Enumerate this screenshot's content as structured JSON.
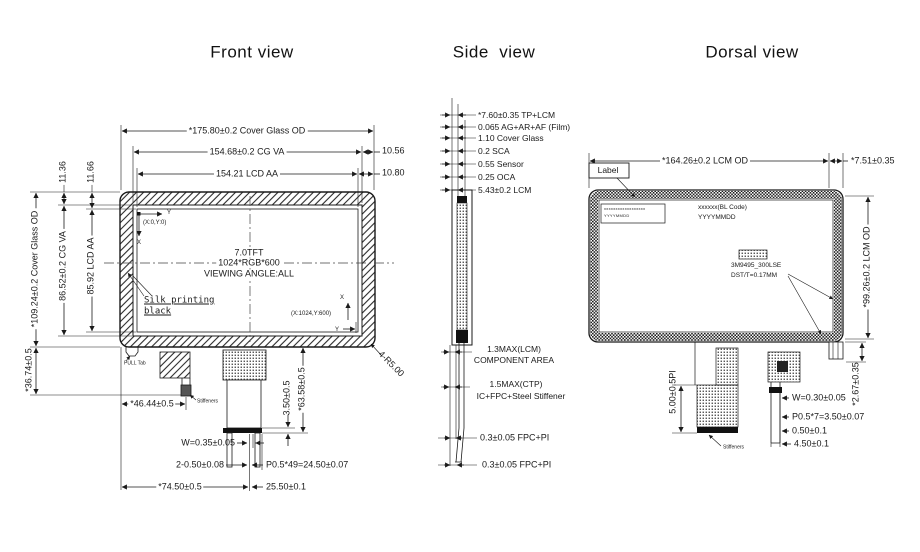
{
  "colors": {
    "ink": "#1a1a1a",
    "paper": "#ffffff"
  },
  "front": {
    "title": "Front view",
    "dims": {
      "width_od": "*175.80±0.2 Cover Glass OD",
      "width_va": "154.68±0.2 CG VA",
      "width_aa": "154.21 LCD AA",
      "right_margin_va": "10.56",
      "right_margin_aa": "10.80",
      "height_od": "*109.24±0.2 Cover Glass OD",
      "height_va": "86.52±0.2 CG VA",
      "height_aa": "85.92 LCD AA",
      "top_margin_va": "11.36",
      "top_margin_aa": "11.66",
      "tail_length": "*36.74±0.5",
      "stiffener_offset": "*46.44±0.5",
      "contact_width": "W=0.35±0.05",
      "hole_dia": "2-0.50±0.08",
      "fpc_offset": "*74.50±0.5",
      "pin_pitch": "P0.5*49=24.50±0.07",
      "connector_width": "25.50±0.1",
      "contact_depth": "3.50±0.5",
      "fpc_length": "*63.58±0.5",
      "corner_radius": "4-R5.00"
    },
    "screen": {
      "line1": "7.0TFT",
      "line2": "1024*RGB*600",
      "line3": "VIEWING ANGLE:ALL",
      "origin": "(X:0,Y:0)",
      "origin_axis_x": "X",
      "origin_axis_y": "Y",
      "corner": "(X:1024,Y:600)",
      "corner_axis_x": "X",
      "corner_axis_y": "Y"
    },
    "notes": {
      "silk_line1": "Silk printing",
      "silk_line2": "black",
      "pull_tab": "PULL Tab",
      "stiffeners": "Stiffeners"
    }
  },
  "side": {
    "title": "Side  view",
    "stack": [
      "*7.60±0.35 TP+LCM",
      "0.065 AG+AR+AF (Film)",
      "1.10 Cover Glass",
      "0.2 SCA",
      "0.55 Sensor",
      "0.25 OCA",
      "5.43±0.2 LCM"
    ],
    "lower": {
      "lcm_max_1": "1.3MAX(LCM)",
      "lcm_max_2": "COMPONENT AREA",
      "ctp_max_1": "1.5MAX(CTP)",
      "ctp_max_2": "IC+FPC+Steel Stiffener",
      "fpc_pi_upper": "0.3±0.05 FPC+PI",
      "fpc_pi_lower": "0.3±0.05 FPC+PI"
    }
  },
  "dorsal": {
    "title": "Dorsal view",
    "dims": {
      "width_od": "*164.26±0.2 LCM OD",
      "right_margin": "*7.51±0.35",
      "height_od": "*99.26±0.2 LCM OD",
      "tab_offset": "*2.67±0.35",
      "pi_length": "5.00±0.5PI",
      "contact_width": "W=0.30±0.05",
      "pin_pitch": "P0.5*7=3.50±0.07",
      "contact_gap": "0.50±0.1",
      "tail_width": "4.50±0.1"
    },
    "notes": {
      "label": "Label",
      "sticker_line1": "xxxxxxxxxxxxxxxxxx",
      "sticker_line2": "YYYYMMDD",
      "bl_code": "xxxxxx(BL Code)",
      "bl_date": "YYYYMMDD",
      "tape_name": "3M9495_300LSE",
      "tape_spec": "DST/T=0.17MM",
      "stiffeners": "Stiffeners"
    }
  }
}
